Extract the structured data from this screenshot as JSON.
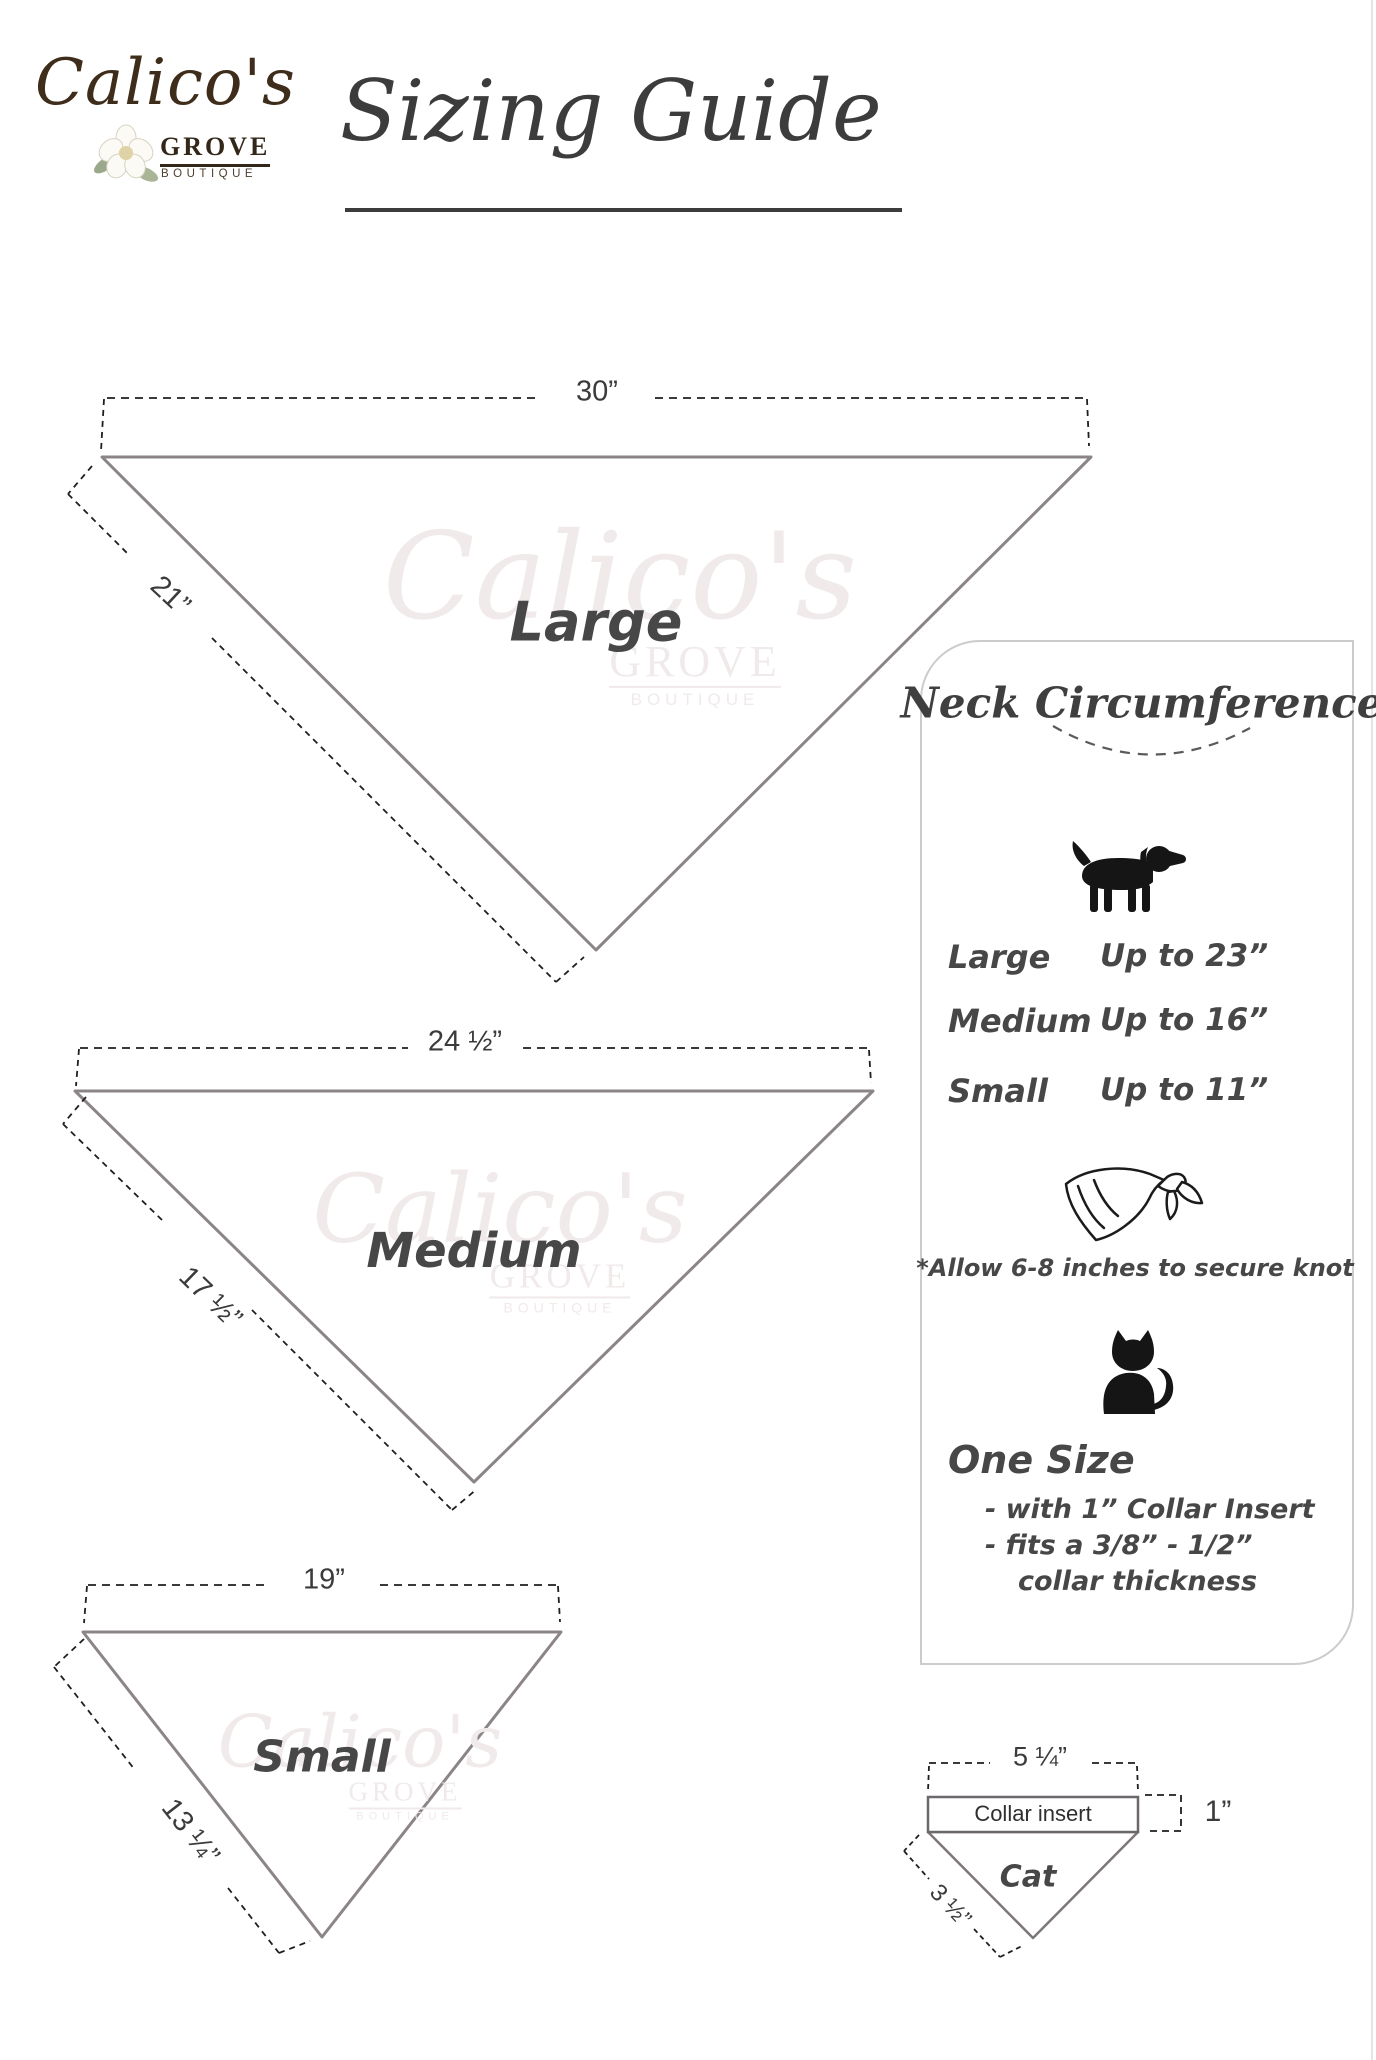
{
  "logo": {
    "name": "Calico's",
    "grove": "GROVE",
    "boutique": "BOUTIQUE"
  },
  "title": "Sizing Guide",
  "sizes": [
    {
      "label": "Large",
      "top": "30”",
      "side": "21”"
    },
    {
      "label": "Medium",
      "top": "24 ½”",
      "side": "17 ½”"
    },
    {
      "label": "Small",
      "top": "19”",
      "side": "13 ¼”"
    }
  ],
  "panel": {
    "title": "Neck Circumference",
    "rows": [
      {
        "size": "Large",
        "fit": "Up to 23”"
      },
      {
        "size": "Medium",
        "fit": "Up to 16”"
      },
      {
        "size": "Small",
        "fit": "Up to 11”"
      }
    ],
    "knot_note": "*Allow 6-8 inches to secure knot",
    "one_size": {
      "heading": "One Size",
      "line1": "- with 1” Collar Insert",
      "line2": "- fits a 3/8” - 1/2”",
      "line3": "collar thickness"
    }
  },
  "cat_diagram": {
    "label": "Cat",
    "collar_label": "Collar insert",
    "width": "5 ¼”",
    "height": "1”",
    "side": "3 ½”"
  },
  "icons": {
    "dog": "dog-icon",
    "bandana": "bandana-icon",
    "cat": "cat-icon",
    "flower": "flower-icon"
  },
  "colors": {
    "ink": "#3a3a3a",
    "triangle_stroke": "#8b8589",
    "dash": "#1f1f1f",
    "panel_border": "#cccccc",
    "logo_brown": "#3f2d1c",
    "watermark": "#f1eaea"
  }
}
